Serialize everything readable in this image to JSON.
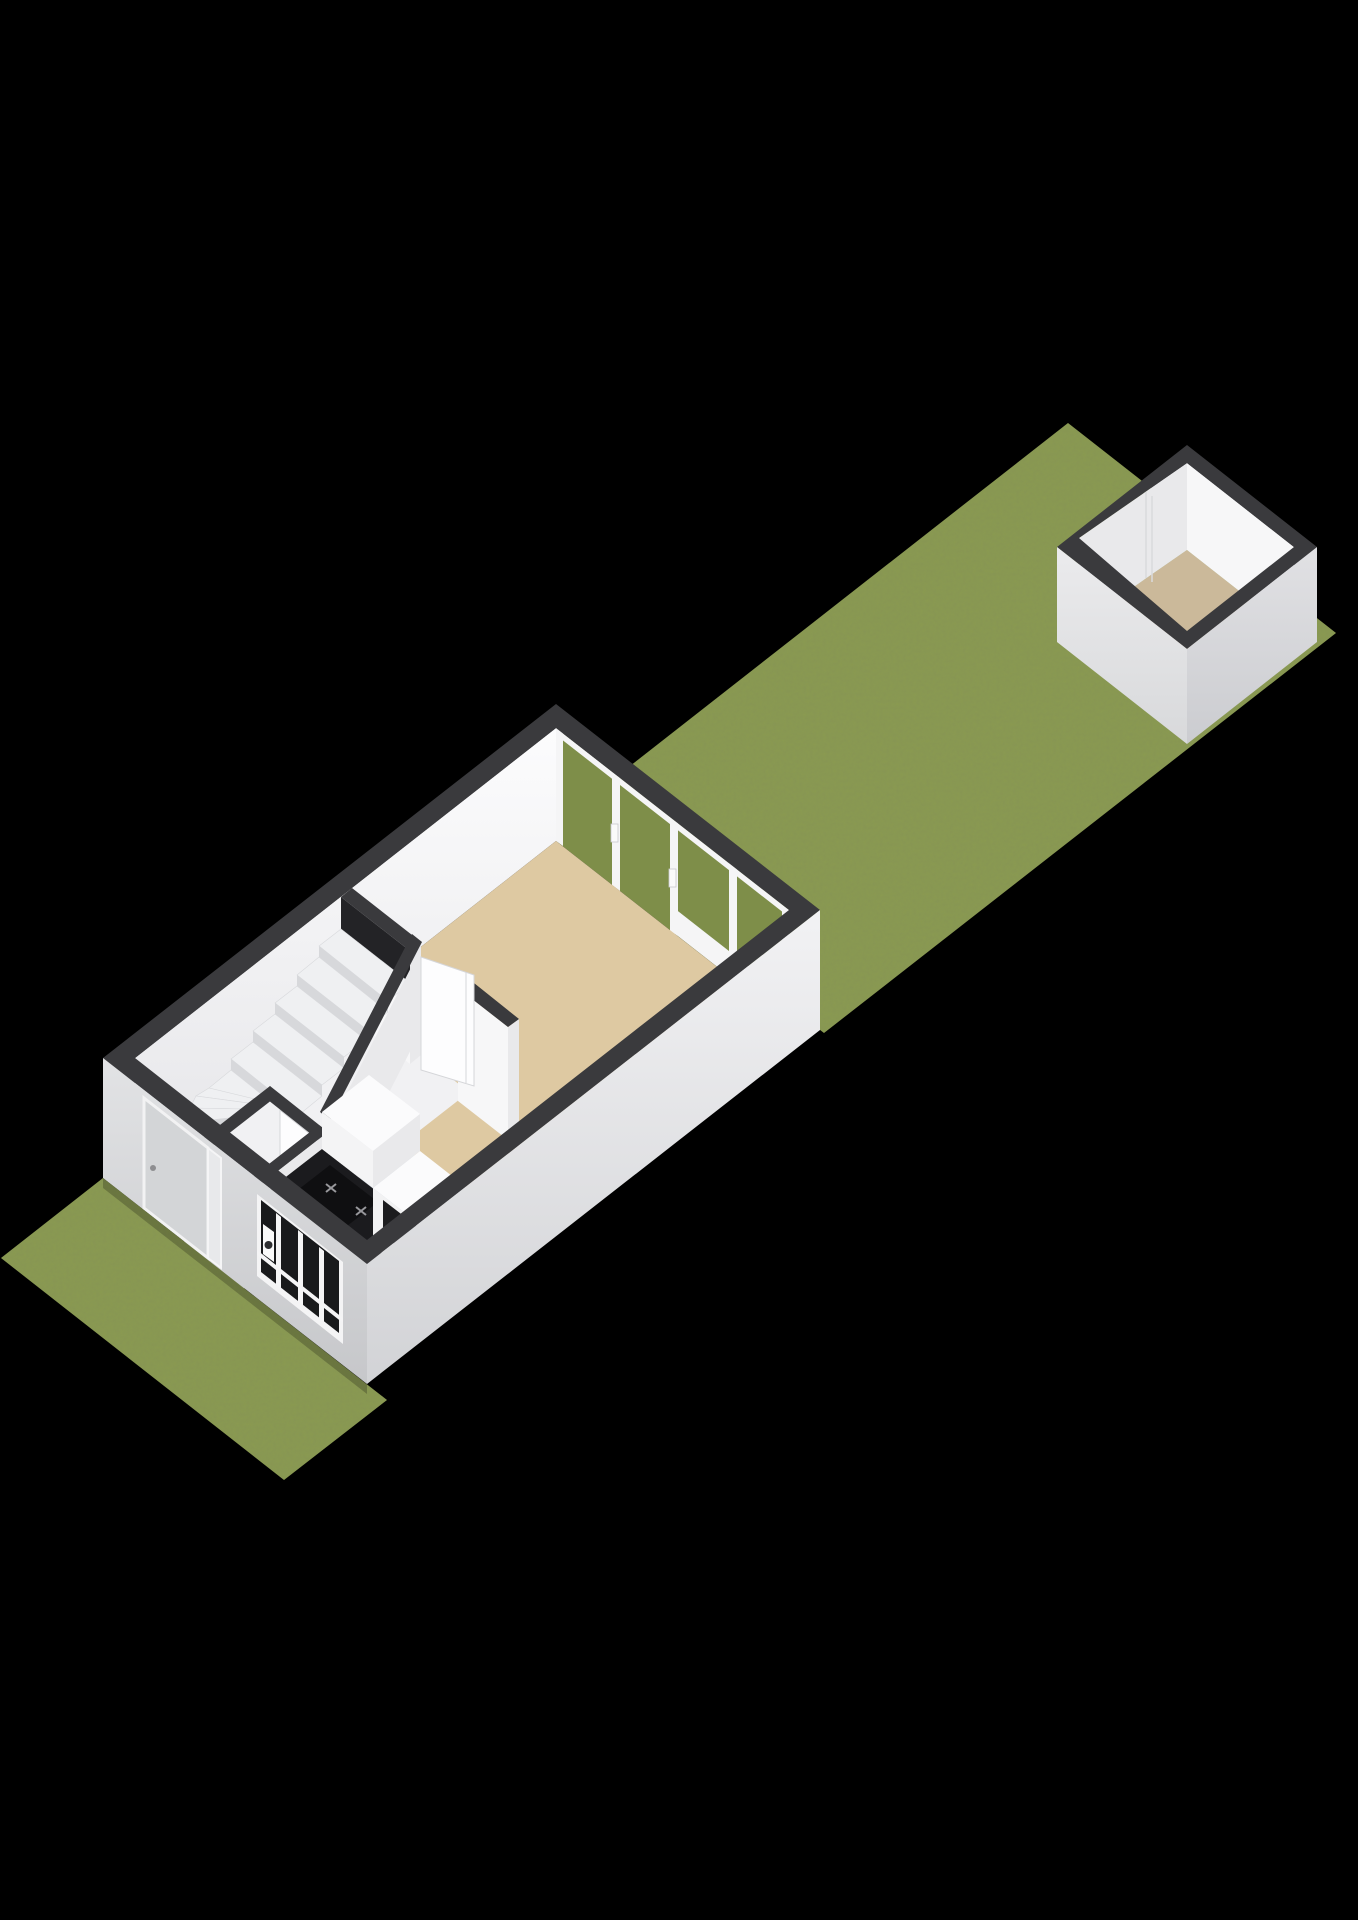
{
  "scene": {
    "type": "3d-floorplan-render",
    "view": "isometric-birdseye",
    "floor": "ground-floor",
    "background": "#000000"
  },
  "palette": {
    "bg": "#000000",
    "grass": "#8a9a50",
    "grassGlass": "#7e8e49",
    "band": "#3a3a3d",
    "innerWall": "#f7f7f8",
    "innerWallShade": "#e9e9eb",
    "livingFloor": "#dec9a2",
    "kitchenFloor": "#c3ccd5",
    "hallFloor": "#f1f1f3",
    "shedFloor": "#cbb99a",
    "stairTread": "#eff0f2",
    "stairRiser": "#d7d8db",
    "counterDark": "#1b1b1e",
    "cabinet": "#fbfbfc",
    "cabinetShade": "#e9e9eb",
    "facadeWall": "#dcdde0",
    "sideWall": "#e9eaec"
  },
  "house": {
    "rooms": [
      {
        "name": "living-room",
        "floor": "beige"
      },
      {
        "name": "kitchen",
        "floor": "blue-gray"
      },
      {
        "name": "hallway",
        "floor": "white"
      },
      {
        "name": "wc",
        "floor": "white"
      },
      {
        "name": "staircase",
        "kind": "winder-stairs"
      }
    ],
    "features": [
      "front-door",
      "door-sidelight",
      "kitchen-window",
      "gas-hob",
      "tall-cabinet",
      "base-cabinet",
      "sliding-glass-doors",
      "interior-door",
      "door-swing-mark"
    ]
  },
  "outbuilding": {
    "name": "shed",
    "roof": "open-cutaway",
    "feature": "shed-door-seam"
  },
  "gardens": [
    {
      "name": "back-garden",
      "position": "behind-house"
    },
    {
      "name": "front-garden",
      "position": "front-of-house"
    }
  ]
}
